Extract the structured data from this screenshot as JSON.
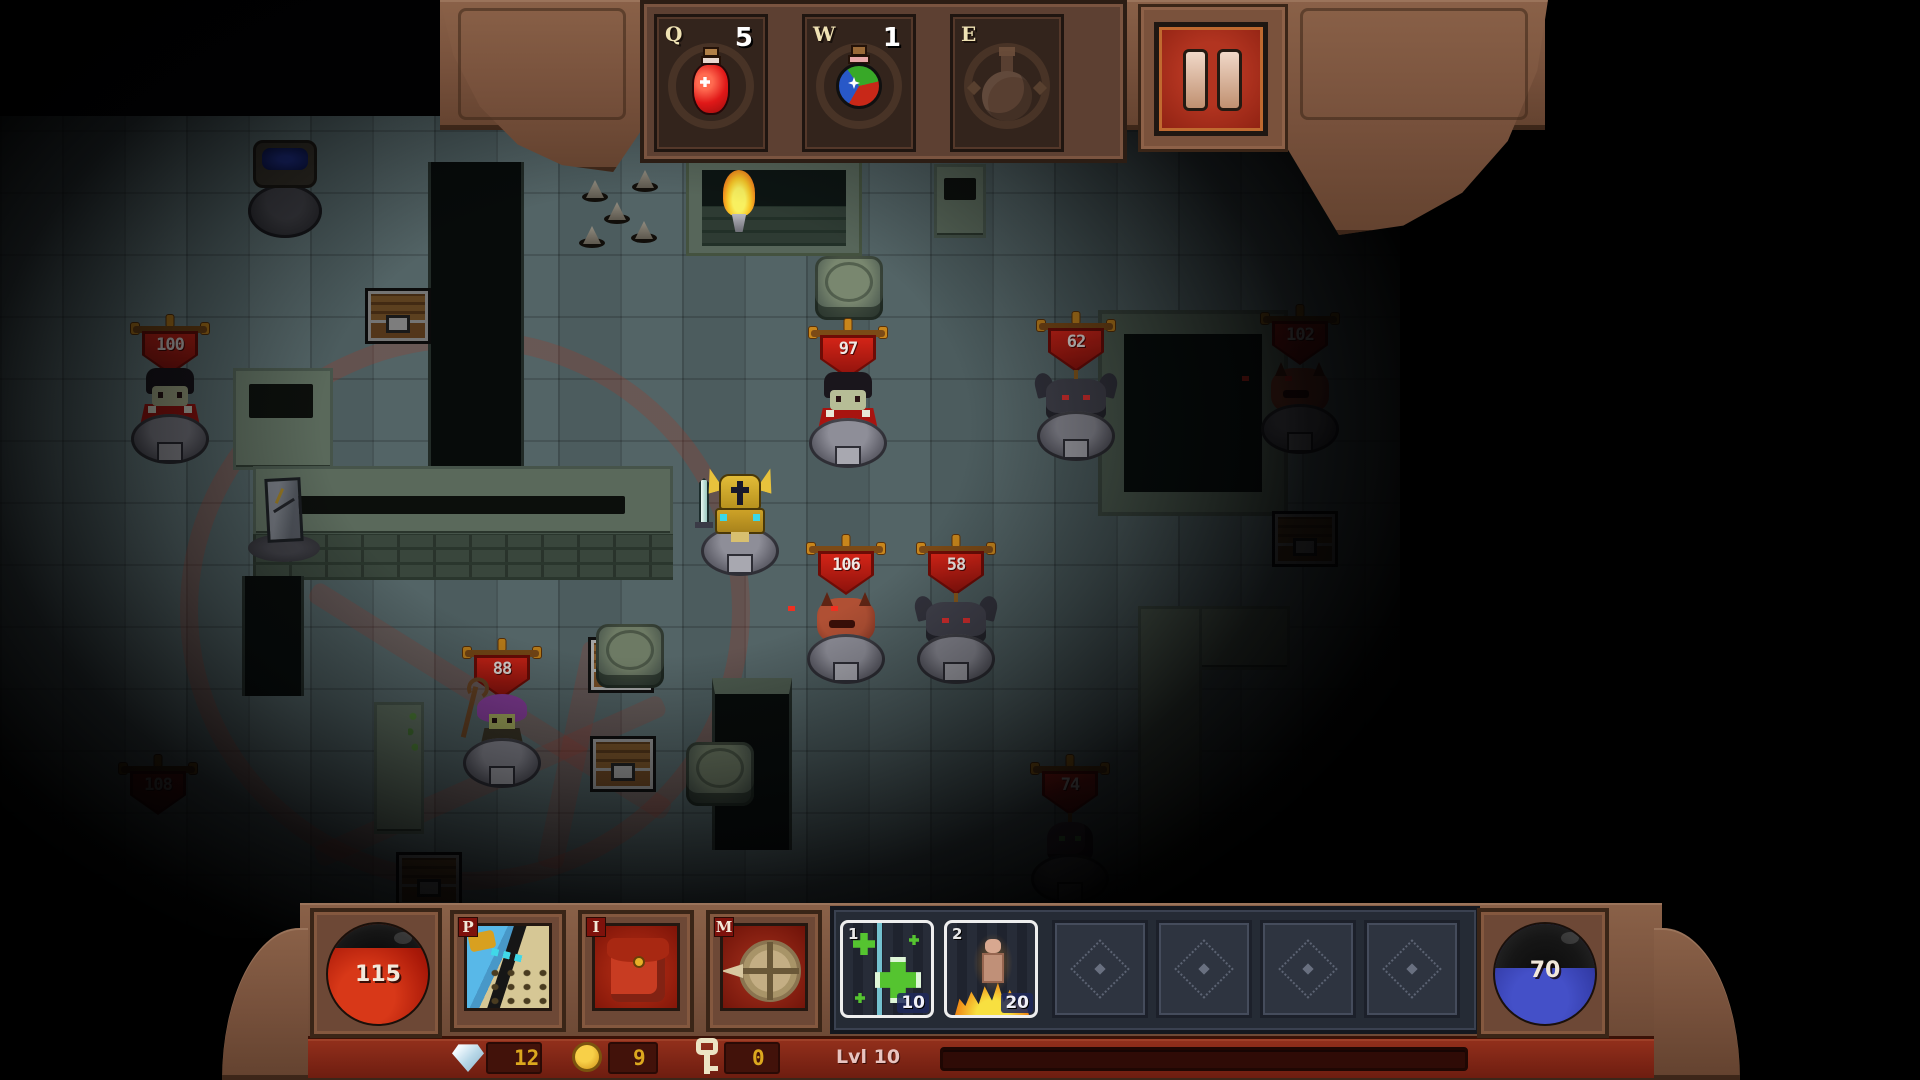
{
  "hud": {
    "top": {
      "potion_slots": [
        {
          "hotkey": "Q",
          "count": "5",
          "item": "red-health-potion"
        },
        {
          "hotkey": "W",
          "count": "1",
          "item": "tricolor-potion"
        },
        {
          "hotkey": "E",
          "count": "",
          "item": "empty"
        }
      ],
      "pause_icon": "pause"
    },
    "bottom": {
      "health_orb": {
        "value": "115",
        "fill_pct": 76,
        "color": "#b41f10"
      },
      "mana_orb": {
        "value": "70",
        "fill_pct": 56,
        "color": "#3640a8"
      },
      "menu_slots": [
        {
          "hotkey": "P",
          "name": "character"
        },
        {
          "hotkey": "I",
          "name": "inventory"
        },
        {
          "hotkey": "M",
          "name": "map"
        }
      ],
      "skill_slots": [
        {
          "hotkey": "1",
          "cost": "10",
          "name": "heal"
        },
        {
          "hotkey": "2",
          "cost": "20",
          "name": "immolate"
        }
      ],
      "empty_skill_slots": 4,
      "currency": {
        "gems": "12",
        "coins": "9",
        "keys": "0"
      },
      "level_label": "Lvl 10"
    }
  },
  "scene": {
    "player": {
      "name": "gold-knight",
      "x": 697,
      "y": 468
    },
    "enemies": [
      {
        "type": "vampire",
        "hp": "100",
        "x": 130,
        "y": 318,
        "dim": 0.7
      },
      {
        "type": "vampire",
        "hp": "97",
        "x": 808,
        "y": 322,
        "dim": 1
      },
      {
        "type": "gargoyle",
        "hp": "62",
        "x": 1036,
        "y": 315,
        "dim": 0.95
      },
      {
        "type": "demon",
        "hp": "102",
        "x": 1260,
        "y": 308,
        "dim": 0.6
      },
      {
        "type": "demon",
        "hp": "106",
        "x": 806,
        "y": 538,
        "dim": 1
      },
      {
        "type": "gargoyle",
        "hp": "58",
        "x": 916,
        "y": 538,
        "dim": 1
      },
      {
        "type": "witch",
        "hp": "88",
        "x": 462,
        "y": 642,
        "dim": 0.9
      },
      {
        "type": "imp",
        "hp": "74",
        "x": 1030,
        "y": 758,
        "dim": 0.7
      },
      {
        "type": "hidden",
        "hp": "108",
        "x": 118,
        "y": 758,
        "dim": 0.45
      }
    ],
    "chests": [
      {
        "x": 365,
        "y": 288,
        "dim": 0.6
      },
      {
        "x": 588,
        "y": 637,
        "dim": 0.85
      },
      {
        "x": 590,
        "y": 736,
        "dim": 0.75
      },
      {
        "x": 396,
        "y": 852,
        "dim": 0.5
      },
      {
        "x": 1272,
        "y": 511,
        "dim": 0.5
      }
    ],
    "pillars": [
      {
        "x": 815,
        "y": 256,
        "dim": 1
      },
      {
        "x": 596,
        "y": 624,
        "dim": 0.9
      },
      {
        "x": 686,
        "y": 742,
        "dim": 0.85
      }
    ],
    "spikes": [
      {
        "x": 582,
        "y": 178
      },
      {
        "x": 632,
        "y": 168
      },
      {
        "x": 604,
        "y": 200
      },
      {
        "x": 579,
        "y": 224
      },
      {
        "x": 631,
        "y": 219
      }
    ]
  }
}
